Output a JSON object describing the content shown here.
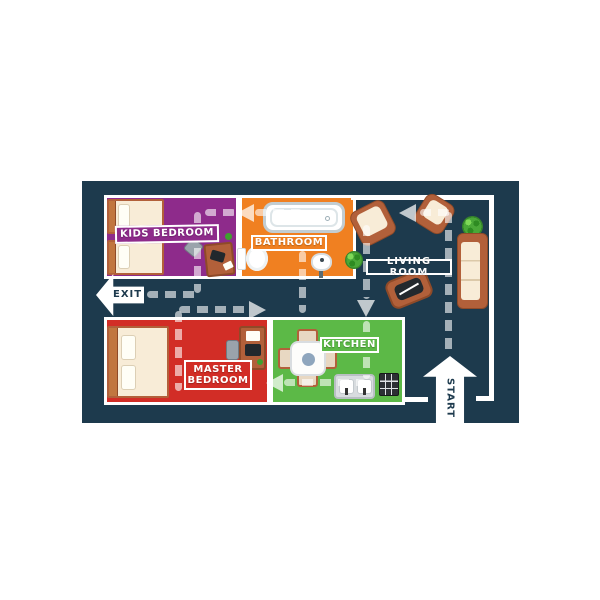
{
  "colors": {
    "board": "#1d3a4d",
    "kids_bedroom": "#8e2b8b",
    "bathroom": "#f08021",
    "living_room": "#1d3a4d",
    "master_bedroom": "#d22d26",
    "kitchen": "#5cb947",
    "wall": "#ffffff",
    "path": "rgba(255,255,255,0.6)",
    "path_arrow": "rgba(255,255,255,0.72)",
    "wood": "#b2603a",
    "cream": "#f8ecd7"
  },
  "rooms": [
    {
      "id": "kids-bedroom",
      "label": "KIDS BEDROOM"
    },
    {
      "id": "bathroom",
      "label": "BATHROOM"
    },
    {
      "id": "living-room",
      "label": "LIVING ROOM"
    },
    {
      "id": "master-bedroom",
      "label": "MASTER BEDROOM"
    },
    {
      "id": "kitchen",
      "label": "KITCHEN"
    }
  ],
  "markers": {
    "exit": "EXIT",
    "start": "START"
  },
  "route": {
    "start_at": "front door (bottom right)",
    "end_at": "exit door (left hallway)",
    "style": "gray dashed line with arrows through living room, kitchen, master bedroom, bathroom and kids bedroom"
  }
}
